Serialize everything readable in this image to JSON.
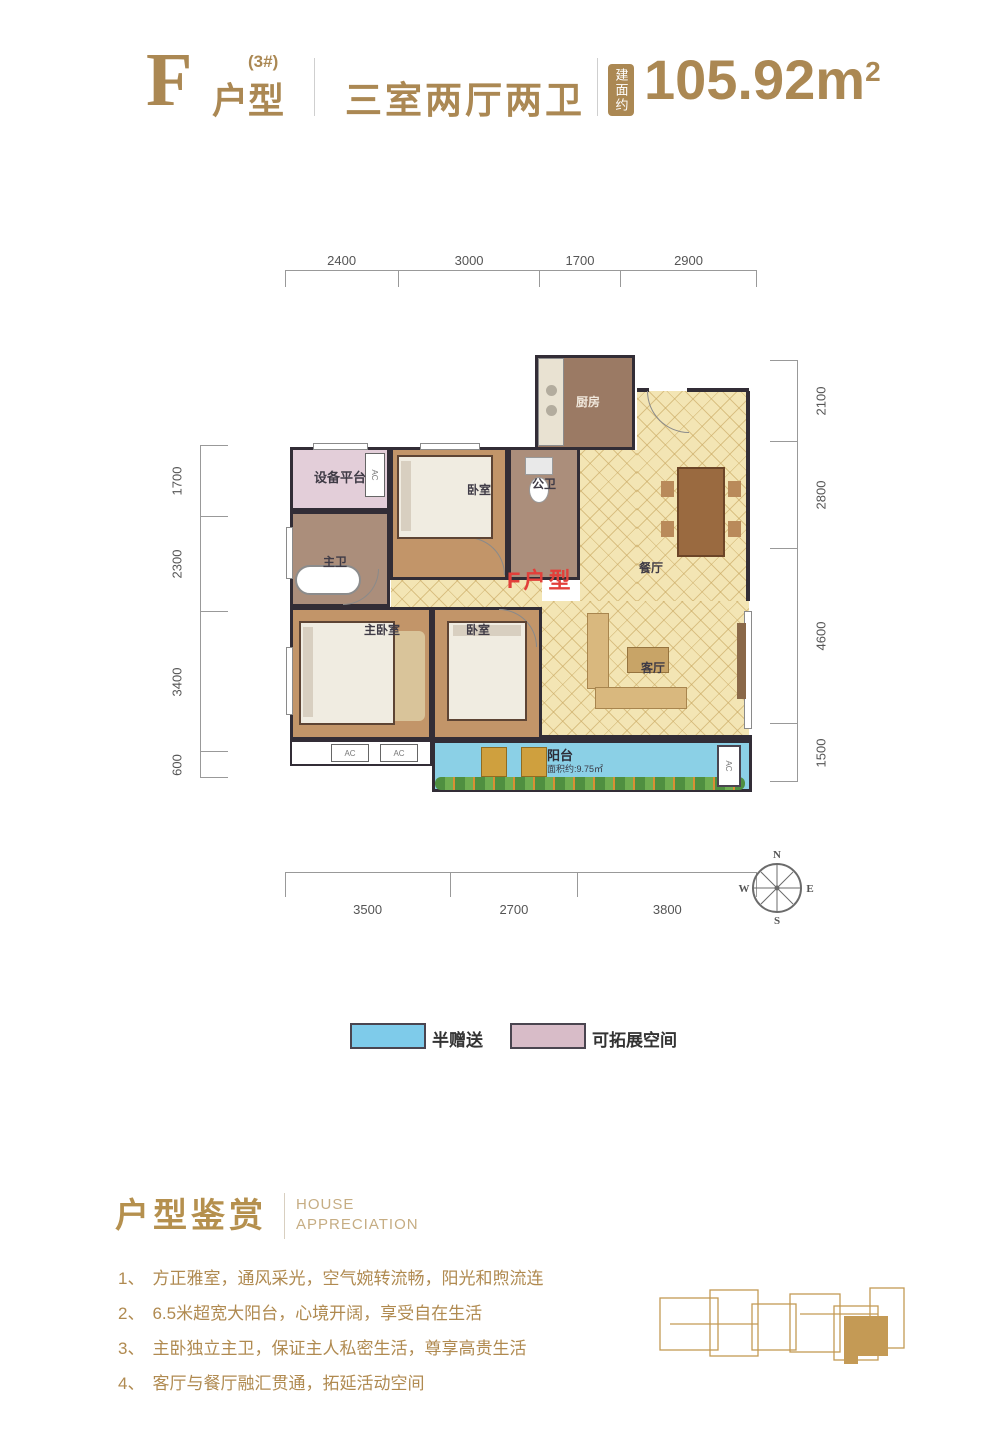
{
  "header": {
    "type_letter": "F",
    "building_sup": "(3#)",
    "type_label": "户型",
    "layout": "三室两厅两卫",
    "area_badge": "建面约",
    "area_value": "105.92m",
    "area_sup": "2"
  },
  "plan": {
    "unit_label": "F户型",
    "ac_label": "AC",
    "rooms": {
      "kitchen": "厨房",
      "dining": "餐厅",
      "equipment": "设备平台",
      "bedroom_top": "卧室",
      "public_bath": "公卫",
      "master_bath": "主卫",
      "master_bedroom": "主卧室",
      "bedroom_bottom": "卧室",
      "living": "客厅",
      "balcony": "阳台",
      "balcony_area": "面积约:9.75㎡"
    },
    "dims": {
      "top": [
        "2400",
        "3000",
        "1700",
        "2900"
      ],
      "bottom": [
        "3500",
        "2700",
        "3800"
      ],
      "left": [
        "1700",
        "2300",
        "3400",
        "600"
      ],
      "right": [
        "2100",
        "2800",
        "4600",
        "1500"
      ]
    },
    "compass": {
      "n": "N",
      "e": "E",
      "s": "S",
      "w": "W"
    }
  },
  "legend": [
    {
      "label": "半赠送",
      "color": "#7ecbea"
    },
    {
      "label": "可拓展空间",
      "color": "#d8bcc8"
    }
  ],
  "appreciation": {
    "title_cn": "户型鉴赏",
    "title_en_1": "HOUSE",
    "title_en_2": "APPRECIATION",
    "items": [
      {
        "num": "1、",
        "text": "方正雅室，通风采光，空气婉转流畅，阳光和煦流连"
      },
      {
        "num": "2、",
        "text": "6.5米超宽大阳台，心境开阔，享受自在生活"
      },
      {
        "num": "3、",
        "text": "主卧独立主卫，保证主人私密生活，尊享高贵生活"
      },
      {
        "num": "4、",
        "text": "客厅与餐厅融汇贯通，拓延活动空间"
      }
    ]
  },
  "colors": {
    "gold": "#ab8853",
    "accent_red": "#e23f3a",
    "tile_yellow": "#f3e5b4",
    "wood": "#c29569",
    "balcony_blue": "#8bd0e6",
    "expand_pink": "#e3ced9"
  }
}
